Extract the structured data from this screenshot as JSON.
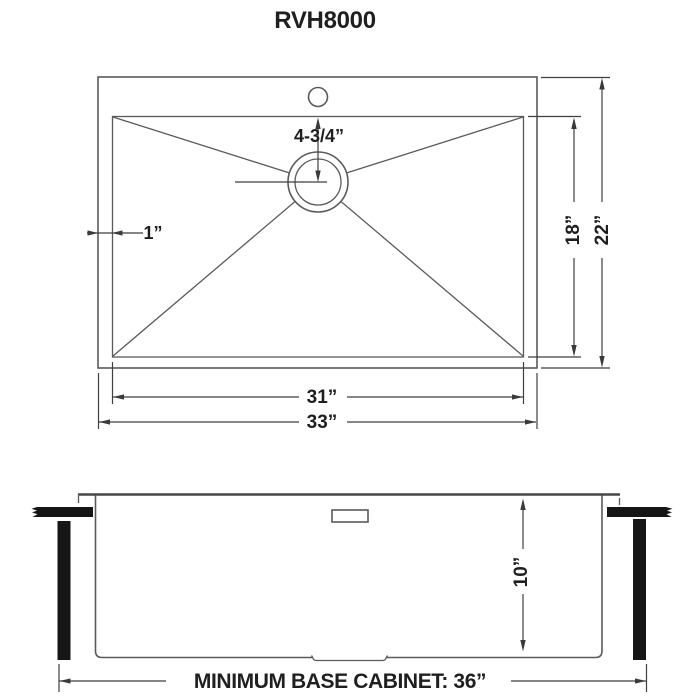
{
  "title": "RVH8000",
  "top_view": {
    "drain_offset_label": "4-3/4”",
    "rim_width_label": "1”",
    "bowl_depth_label": "18”",
    "overall_depth_label": "22”",
    "bowl_width_label": "31”",
    "overall_width_label": "33”"
  },
  "side_view": {
    "bowl_height_label": "10”",
    "base_cabinet_label": "MINIMUM BASE CABINET: 36”"
  }
}
